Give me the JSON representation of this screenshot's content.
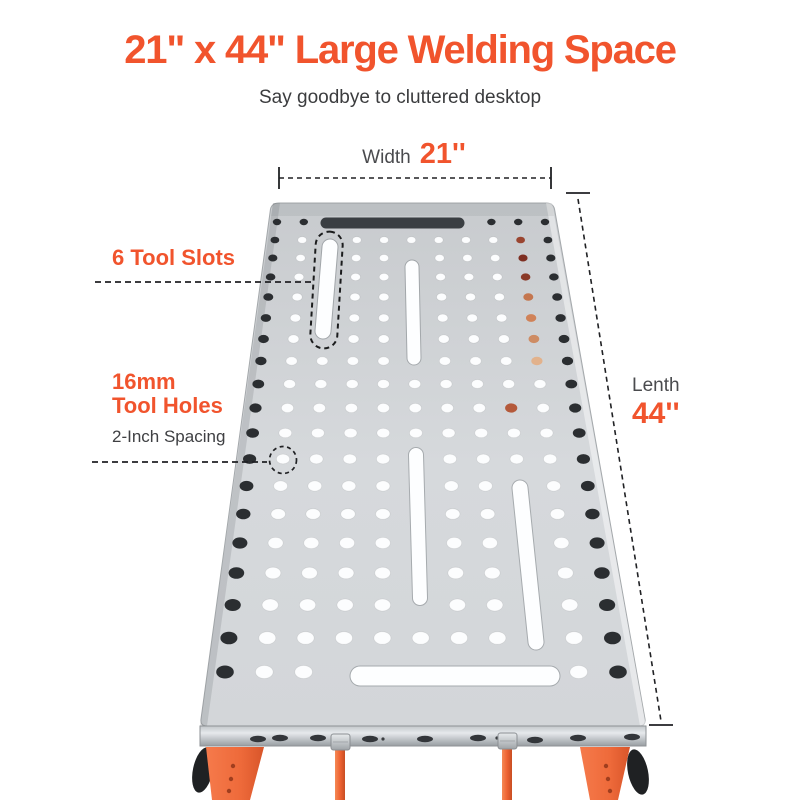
{
  "header": {
    "title": "21\" x 44\" Large Welding Space",
    "subtitle": "Say goodbye to cluttered desktop"
  },
  "dimensions": {
    "width": {
      "label": "Width",
      "value": "21''"
    },
    "length": {
      "label": "Lenth",
      "value": "44''"
    }
  },
  "callouts": {
    "tool_slots": "6 Tool Slots",
    "tool_holes_line1": "16mm",
    "tool_holes_line2": "Tool Holes",
    "tool_holes_sub": "2-Inch Spacing"
  },
  "colors": {
    "accent": "#F1542D",
    "table_gray": "#D3D6D9",
    "dark_hole": "#2B2E31",
    "white_hole": "#FCFDFE",
    "leg_orange": "#EE6A3A",
    "annotation_dash": "#202124"
  },
  "illustration": {
    "table": {
      "top_corners": [
        [
          273,
          203
        ],
        [
          552,
          203
        ],
        [
          646,
          726
        ],
        [
          200,
          726
        ]
      ],
      "band": {
        "points": [
          [
            200,
            726
          ],
          [
            646,
            726
          ],
          [
            646,
            746
          ],
          [
            200,
            746
          ]
        ],
        "ovals": [
          [
            258,
            739
          ],
          [
            280,
            738
          ],
          [
            318,
            738
          ],
          [
            370,
            739
          ],
          [
            425,
            739
          ],
          [
            478,
            738
          ],
          [
            535,
            740
          ],
          [
            578,
            738
          ],
          [
            632,
            737
          ]
        ],
        "dots": [
          [
            383,
            739
          ],
          [
            497,
            738
          ]
        ]
      },
      "grid": {
        "rows_y": [
          222,
          240,
          258,
          277,
          297,
          318,
          339,
          361,
          384,
          408,
          433,
          459,
          486,
          514,
          543,
          573,
          605,
          638,
          672
        ],
        "col_top": {
          "x0": 277,
          "dx": 26.8
        },
        "col_bottom": {
          "x0": 225,
          "dx": 39.3
        },
        "y_top": 222,
        "y_bottom": 672,
        "cols": 11,
        "hole_rx": [
          4.2,
          8.8
        ],
        "hole_ry": [
          3.2,
          6.5
        ],
        "dark_cols": [
          0,
          10
        ],
        "copper_col": 9,
        "copper_rows": {
          "1": "#9A4530",
          "2": "#7E2F22",
          "3": "#8A3A28",
          "4": "#C4764F",
          "5": "#D08258",
          "6": "#CE8C64",
          "7": "#E2B28C"
        },
        "extra_dark": [
          [
            0,
            1
          ],
          [
            0,
            8
          ],
          [
            0,
            9
          ]
        ],
        "extra_copper": [
          [
            9,
            8,
            "#B4593A"
          ]
        ],
        "skips": {
          "0": [
            2,
            3,
            4,
            5,
            6,
            7
          ],
          "1": [
            2
          ],
          "2": [
            2,
            5
          ],
          "3": [
            2,
            5
          ],
          "4": [
            2,
            5
          ],
          "5": [
            2,
            5
          ],
          "6": [
            2,
            5
          ],
          "7": [
            5
          ],
          "11": [
            5
          ],
          "12": [
            5,
            8
          ],
          "13": [
            5,
            8
          ],
          "14": [
            5,
            8
          ],
          "15": [
            5,
            8
          ],
          "16": [
            5,
            8
          ],
          "17": [
            8
          ],
          "18": [
            3,
            4,
            5,
            6,
            7,
            8
          ]
        }
      },
      "slots": {
        "dark_top": {
          "x1": 326,
          "y1": 223,
          "x2": 459,
          "y2": 223,
          "w": 11,
          "color": "#3A3E42"
        },
        "white": [
          {
            "x1": 330,
            "y1": 247,
            "x2": 323,
            "y2": 331,
            "w": 15
          },
          {
            "x1": 412,
            "y1": 267,
            "x2": 414,
            "y2": 358,
            "w": 13
          },
          {
            "x1": 416,
            "y1": 455,
            "x2": 420,
            "y2": 598,
            "w": 14
          },
          {
            "x1": 520,
            "y1": 488,
            "x2": 536,
            "y2": 642,
            "w": 15
          },
          {
            "x1": 360,
            "y1": 676,
            "x2": 550,
            "y2": 676,
            "w": 19
          }
        ],
        "white_color": "#FDFEFF"
      }
    },
    "legs": {
      "left_bracket": [
        [
          206,
          747
        ],
        [
          264,
          747
        ],
        [
          250,
          800
        ],
        [
          212,
          800
        ]
      ],
      "right_bracket": [
        [
          580,
          747
        ],
        [
          630,
          747
        ],
        [
          618,
          800
        ],
        [
          590,
          800
        ]
      ],
      "bracket_holes_left": [
        [
          233,
          766
        ],
        [
          231,
          779
        ],
        [
          229,
          791
        ]
      ],
      "bracket_holes_right": [
        [
          606,
          766
        ],
        [
          608,
          779
        ],
        [
          610,
          791
        ]
      ],
      "knobs": [
        {
          "cx": 203,
          "cy": 770,
          "rx": 10,
          "ry": 23,
          "rot": 12
        },
        {
          "cx": 638,
          "cy": 772,
          "rx": 10,
          "ry": 23,
          "rot": -12
        }
      ],
      "rods": [
        {
          "x": 340,
          "w": 10,
          "y1": 746,
          "y2": 800
        },
        {
          "x": 507,
          "w": 10,
          "y1": 746,
          "y2": 800
        }
      ],
      "bolts": [
        {
          "x": 331,
          "y": 734,
          "w": 19,
          "h": 16
        },
        {
          "x": 498,
          "y": 733,
          "w": 19,
          "h": 16
        }
      ]
    },
    "annotations": {
      "width_dim": {
        "x1": 279,
        "x2": 551,
        "y": 178,
        "tick_y1": 167,
        "tick_y2": 189
      },
      "length_dim": {
        "x1": 578,
        "y1": 199,
        "x2": 661,
        "y2": 721,
        "ticks": [
          [
            566,
            193,
            590,
            193
          ],
          [
            649,
            725,
            673,
            725
          ]
        ]
      },
      "leader_slots": {
        "x1": 95,
        "y1": 282,
        "x2": 313,
        "y2": 282
      },
      "leader_holes": {
        "x1": 92,
        "y1": 462,
        "x2": 267,
        "y2": 462
      },
      "dashed_circle": {
        "cx": 283,
        "cy": 460,
        "r": 13.5
      },
      "slot_outline": {
        "x": 313,
        "y": 231.5,
        "w": 27,
        "h": 117,
        "rx": 13.5,
        "angle": 3.4,
        "cx": 326.5,
        "cy": 290
      }
    }
  }
}
